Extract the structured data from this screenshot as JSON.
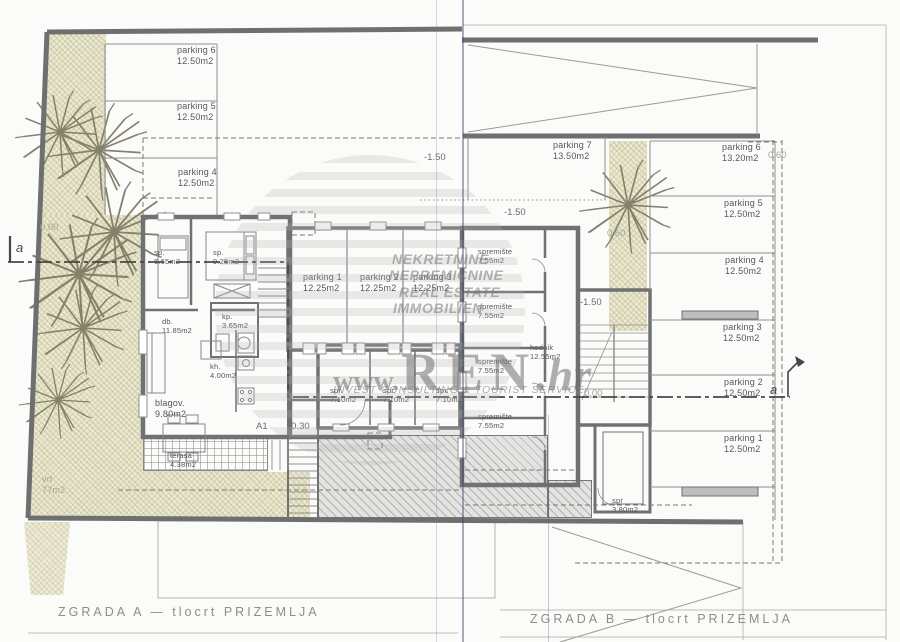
{
  "captions": {
    "a": "ZGRADA A — tlocrt PRIZEMLJA",
    "b": "ZGRADA B — tlocrt PRIZEMLJA"
  },
  "watermark": {
    "words": [
      "NEKRETNINE",
      "NEPREMIČNINE",
      "REAL ESTATE",
      "IMMOBILIEN",
      "IMMOBILI"
    ],
    "www": "www.",
    "name": "REN",
    "tld": ".hr",
    "tagline": "INVEST CONSULTING & TOURIST SERVICE"
  },
  "building_a": {
    "parking_row": [
      {
        "name": "parking 6",
        "area": "12.50m2"
      },
      {
        "name": "parking 5",
        "area": "12.50m2"
      },
      {
        "name": "parking 4",
        "area": "12.50m2"
      }
    ],
    "garage": [
      {
        "name": "parking 1",
        "area": "12.25m2"
      },
      {
        "name": "parking 2",
        "area": "12.25m2"
      },
      {
        "name": "parking 3",
        "area": "12.25m2"
      }
    ],
    "storage": [
      {
        "name": "spr.",
        "area": "7.10m2"
      },
      {
        "name": "spr.",
        "area": "7.10m2"
      },
      {
        "name": "spr.",
        "area": "7.10m2"
      }
    ],
    "rooms": {
      "bedroom1": {
        "name": "sp.",
        "area": "6.65m2"
      },
      "bedroom2": {
        "name": "sp.",
        "area": "9.25m2"
      },
      "bath": {
        "name": "kp.",
        "area": "3.65m2"
      },
      "living": {
        "name": "db.",
        "area": "11.85m2"
      },
      "kitchen": {
        "name": "kh.",
        "area": "4.00m2"
      },
      "dining": {
        "name": "blagov.",
        "area": "9.80m2"
      },
      "terrace": {
        "name": "terasa",
        "area": "4.38m2"
      },
      "garden": {
        "name": "vrt",
        "area": "77m2"
      }
    },
    "door_tag": "A1"
  },
  "building_b": {
    "parking7": {
      "name": "parking 7",
      "area": "13.50m2"
    },
    "parking_col": [
      {
        "name": "parking 6",
        "area": "13.20m2"
      },
      {
        "name": "parking 5",
        "area": "12.50m2"
      },
      {
        "name": "parking 4",
        "area": "12.50m2"
      },
      {
        "name": "parking 3",
        "area": "12.50m2"
      },
      {
        "name": "parking 2",
        "area": "12.50m2"
      },
      {
        "name": "parking 1",
        "area": "12.50m2"
      }
    ],
    "storage": [
      {
        "name": "spremište",
        "area": "7.55m2"
      },
      {
        "name": "spremište",
        "area": "7.55m2"
      },
      {
        "name": "spremište",
        "area": "7.55m2"
      },
      {
        "name": "spremište",
        "area": "7.55m2"
      }
    ],
    "hall": {
      "name": "hodnik",
      "area": "12.55m2"
    },
    "storage_small": {
      "name": "spr",
      "area": "3.80m2"
    }
  },
  "levels": {
    "ground_a": "0.00",
    "ground_b": "0.00",
    "minus150_1": "-1.50",
    "minus150_2": "-1.50",
    "minus150_3": "-1.50",
    "minus030": "-0.30",
    "plus060_1": "0.60",
    "plus060_2": "0.60"
  },
  "section": {
    "left": "a",
    "right": "a"
  }
}
